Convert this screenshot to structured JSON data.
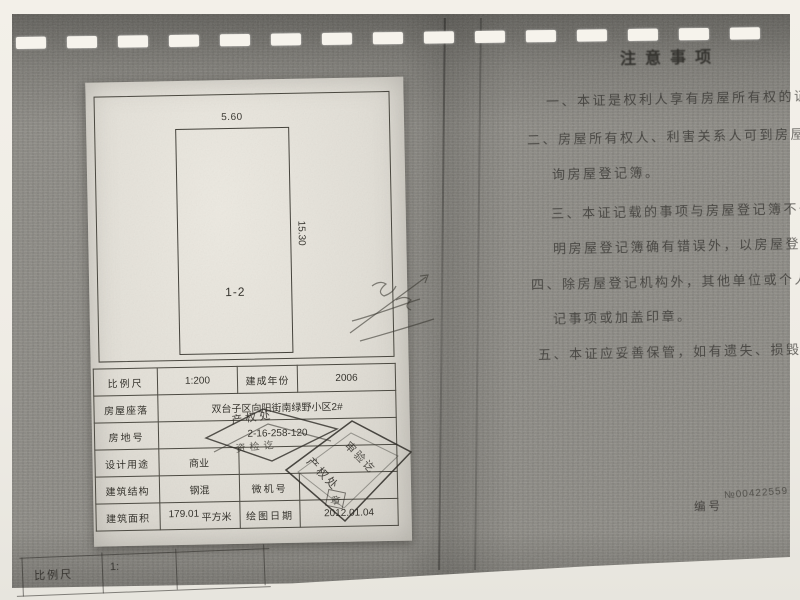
{
  "floor_plan": {
    "width_label": "5.60",
    "height_label": "15.30",
    "room_label": "1-2"
  },
  "spec_table": {
    "rows": [
      {
        "c1": "比例尺",
        "c2": "1:200",
        "c3": "建成年份",
        "c4": "2006"
      },
      {
        "c1": "房屋座落",
        "c2": "双台子区向阳街南绿野小区2#"
      },
      {
        "c1": "房地号",
        "c2": "2-16-258-120"
      },
      {
        "c1": "设计用途",
        "c2": "商业"
      },
      {
        "c1": "建筑结构",
        "c2": "钢混",
        "c3": "微机号",
        "c4": ""
      },
      {
        "c1": "建筑面积",
        "c2": "179.01",
        "c2_unit": "平方米",
        "c3": "绘图日期",
        "c4": "2012.01.04"
      }
    ]
  },
  "stamps": {
    "flat_stamp_line1": "产权处",
    "flat_stamp_line2": "资检讫",
    "diamond_stamp_line1": "产权处",
    "diamond_stamp_line2": "审验讫",
    "diamond_stamp_seal": "章"
  },
  "notice": {
    "title": "注意事项",
    "lines": [
      "一、本证是权利人享有房屋所有权的证明。",
      "二、房屋所有权人、利害关系人可到房屋登记机",
      "询房屋登记簿。",
      "三、本证记载的事项与房屋登记簿不一致的，除",
      "明房屋登记簿确有错误外，以房屋登记簿为准。",
      "四、除房屋登记机构外，其他单位或个人不得在",
      "记事项或加盖印章。",
      "五、本证应妥善保管，如有遗失、损毁的，可向"
    ],
    "serial_label": "编号",
    "serial_number": "№00422559"
  },
  "ghost_footer": {
    "label": "比例尺",
    "value": "1:"
  },
  "colors": {
    "dark_page": "#8b8983",
    "light_sheet": "#e3e0d8",
    "paper_margin": "#f1eee7",
    "ink": "#36342e",
    "stamp_ink": "#2e2c27"
  }
}
